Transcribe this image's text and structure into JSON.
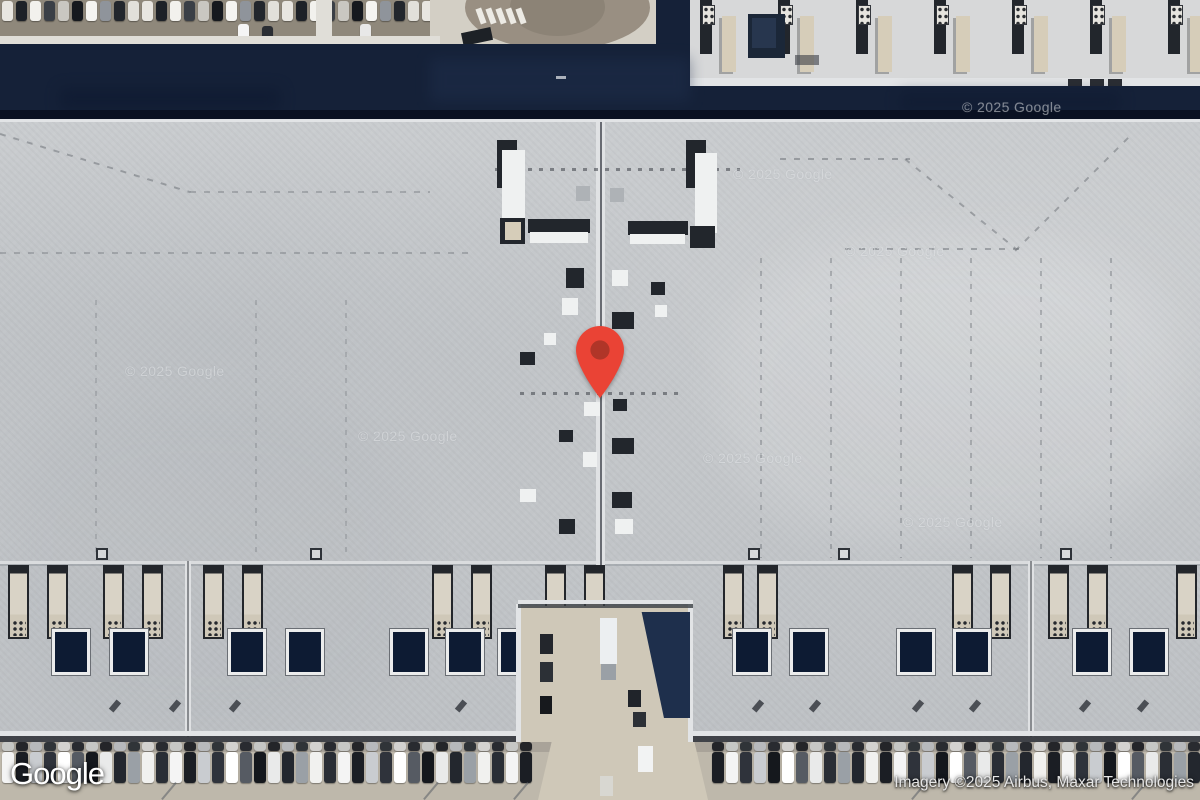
{
  "overlay": {
    "logo_text": "Google",
    "attribution": "Imagery ©2025 Airbus, Maxar Technologies"
  },
  "map": {
    "watermark_text": "© 2025 Google",
    "watermarks": [
      {
        "x": 125,
        "y": 363
      },
      {
        "x": 358,
        "y": 428
      },
      {
        "x": 703,
        "y": 450
      },
      {
        "x": 903,
        "y": 514
      },
      {
        "x": 733,
        "y": 166
      },
      {
        "x": 845,
        "y": 243
      },
      {
        "x": 962,
        "y": 99
      }
    ],
    "pin": {
      "x": 600,
      "y": 398,
      "body": "#EA4335",
      "dot": "#B03528"
    },
    "colors": {
      "dirt": "#8f887b",
      "pave": "#d3cfc5",
      "walk": "#e0ded8",
      "bldg": "#d7d8d9",
      "edge": "#e2e4e6",
      "navy": "#152138",
      "navyDark": "#0a1122",
      "navyLight": "#20304e",
      "roof": "#c6c9cc",
      "dark": "#22262c",
      "white": "#eff1f1",
      "beige": "#d6cdb9",
      "tan": "#cfc8b8",
      "lot": "#beb8ab",
      "lotDark": "#a9a399"
    },
    "features": [
      {
        "x": 0,
        "y": 0,
        "w": 440,
        "h": 50,
        "f": "$dirt"
      },
      {
        "x0": 2,
        "y": 1,
        "w": 11,
        "h": 20,
        "gap": 3,
        "count": 31,
        "cls": "car",
        "colors": [
          "#e8e6e1",
          "#1d2127",
          "#f2f1ed",
          "#3a3f46",
          "#c9c7c1",
          "#16191e",
          "#f5f4f0",
          "#8f949b",
          "#22262c",
          "#e2e0da"
        ]
      },
      {
        "x": 238,
        "y": 24,
        "w": 11,
        "h": 16,
        "f": "#f5f5f5",
        "cls": "car"
      },
      {
        "x": 262,
        "y": 26,
        "w": 11,
        "h": 14,
        "f": "#2a2d33",
        "cls": "car"
      },
      {
        "x": 360,
        "y": 24,
        "w": 11,
        "h": 15,
        "f": "#e8e8e8",
        "cls": "car"
      },
      {
        "x": 316,
        "y": 0,
        "w": 16,
        "h": 44,
        "f": "$walk"
      },
      {
        "x": 430,
        "y": 0,
        "w": 240,
        "h": 48,
        "f": "$pave"
      },
      {
        "x": 465,
        "y": -35,
        "w": 185,
        "h": 85,
        "f": "#998f82",
        "cls": "ell"
      },
      {
        "x": 510,
        "y": -22,
        "w": 95,
        "h": 58,
        "f": "#8a8174",
        "cls": "ell",
        "op": 0.85
      },
      {
        "xs": [
          478,
          488,
          498,
          508,
          518
        ],
        "y": 8,
        "w": 6,
        "h": 16,
        "f": "#eceae4",
        "rot": -20
      },
      {
        "x": 462,
        "y": 30,
        "w": 30,
        "h": 13,
        "f": "#1d2126",
        "rot": -12
      },
      {
        "x": 688,
        "y": 0,
        "w": 512,
        "h": 84,
        "f": "$bldg"
      },
      {
        "x0": 700,
        "y": 0,
        "w": 40,
        "h": 76,
        "gap": 38,
        "count": 7,
        "cls": "mod"
      },
      {
        "x0": 702,
        "y": 5,
        "w": 13,
        "h": 20,
        "gap": 65,
        "count": 7,
        "cls": "grid"
      },
      {
        "x": 748,
        "y": 14,
        "w": 37,
        "h": 44,
        "f": "#1b2738"
      },
      {
        "x": 752,
        "y": 18,
        "w": 24,
        "h": 30,
        "f": "#27364e"
      },
      {
        "x": 795,
        "y": 55,
        "w": 24,
        "h": 10,
        "f": "#3a3e44",
        "op": 0.6
      },
      {
        "x": 688,
        "y": 78,
        "w": 512,
        "h": 10,
        "f": "$edge"
      },
      {
        "xs": [
          1068,
          1090,
          1108
        ],
        "y": 79,
        "w": 14,
        "h": 8,
        "f": "#2a2d33"
      },
      {
        "x": 0,
        "y": 36,
        "w": 440,
        "h": 10,
        "f": "$walk"
      },
      {
        "x": 0,
        "y": 44,
        "w": 658,
        "h": 76,
        "f": "$navy"
      },
      {
        "x": 656,
        "y": 0,
        "w": 34,
        "h": 120,
        "f": "$navy"
      },
      {
        "x": 688,
        "y": 86,
        "w": 512,
        "h": 34,
        "f": "$navy"
      },
      {
        "x": 430,
        "y": 58,
        "w": 260,
        "h": 44,
        "f": "$navyLight",
        "op": 0.45,
        "cls": "blur"
      },
      {
        "x": 60,
        "y": 88,
        "w": 220,
        "h": 22,
        "f": "#0e1930",
        "op": 0.6,
        "cls": "blur"
      },
      {
        "x": 900,
        "y": 92,
        "w": 220,
        "h": 20,
        "f": "#0e1930",
        "op": 0.5,
        "cls": "blur"
      },
      {
        "x": 556,
        "y": 76,
        "w": 10,
        "h": 3,
        "f": "#cfd4da",
        "op": 0.8
      },
      {
        "x": 0,
        "y": 110,
        "w": 1200,
        "h": 10,
        "f": "$navyDark"
      },
      {
        "x": 0,
        "y": 119,
        "w": 1200,
        "h": 4,
        "f": "$edge"
      },
      {
        "x": 0,
        "y": 122,
        "w": 1200,
        "h": 620,
        "f": "$roof"
      },
      {
        "x": 0,
        "y": 122,
        "w": 1200,
        "h": 620,
        "cls": "wash1"
      },
      {
        "x": 0,
        "y": 400,
        "w": 420,
        "h": 330,
        "f": "#a9aeb4",
        "op": 0.16,
        "cls": "blur2"
      },
      {
        "x": 720,
        "y": 240,
        "w": 460,
        "h": 300,
        "f": "#ffffff",
        "op": 0.12,
        "cls": "blur2"
      },
      {
        "x": 0,
        "y": 122,
        "w": 1200,
        "h": 620,
        "cls": "grain"
      },
      {
        "x": 0,
        "y": 561,
        "w": 1200,
        "h": 3,
        "f": "#dadcde"
      },
      {
        "x": 0,
        "y": 564,
        "w": 1200,
        "h": 2,
        "f": "#90959b",
        "op": 0.5
      },
      {
        "x": 596,
        "y": 122,
        "w": 9,
        "h": 492,
        "f": "#e0e2e4"
      },
      {
        "x": 600,
        "y": 122,
        "w": 2,
        "h": 492,
        "f": "#4a4e55",
        "op": 0.8
      },
      {
        "x": 185,
        "y": 561,
        "w": 6,
        "h": 176,
        "f": "#dfe1e3"
      },
      {
        "x": 187,
        "y": 561,
        "w": 2,
        "h": 176,
        "f": "#5a5e64",
        "op": 0.65
      },
      {
        "x": 1028,
        "y": 561,
        "w": 6,
        "h": 176,
        "f": "#dfe1e3"
      },
      {
        "x": 1030,
        "y": 561,
        "w": 2,
        "h": 176,
        "f": "#5a5e64",
        "op": 0.65
      },
      {
        "xs": [
          760,
          830,
          900,
          970,
          1040,
          1110
        ],
        "y": 258,
        "w": 2,
        "h": 300,
        "cls": "dashv"
      },
      {
        "xs": [
          95,
          255,
          345
        ],
        "y": 300,
        "w": 2,
        "h": 258,
        "cls": "dashv",
        "op": 0.22
      },
      {
        "x": 0,
        "y": 252,
        "w": 470,
        "h": 2,
        "cls": "dashh",
        "op": 0.3
      },
      {
        "x": 780,
        "y": 158,
        "w": 130,
        "h": 2,
        "cls": "dashh"
      },
      {
        "x": 845,
        "y": 248,
        "w": 175,
        "h": 2,
        "cls": "dashh"
      },
      {
        "x": 905,
        "y": 158,
        "w": 142,
        "h": 2,
        "cls": "dashh",
        "rot": 39
      },
      {
        "x": 1015,
        "y": 250,
        "w": 162,
        "h": 2,
        "cls": "dashh",
        "rot": -45
      },
      {
        "x": 0,
        "y": 133,
        "w": 199,
        "h": 2,
        "cls": "dashh",
        "rot": 17
      },
      {
        "x": 190,
        "y": 191,
        "w": 240,
        "h": 2,
        "cls": "dashh",
        "op": 0.3
      },
      {
        "x": 495,
        "y": 168,
        "w": 245,
        "h": 3,
        "cls": "dots"
      },
      {
        "x": 520,
        "y": 392,
        "w": 160,
        "h": 3,
        "cls": "dots"
      },
      {
        "x": 497,
        "y": 140,
        "w": 20,
        "h": 48,
        "f": "$dark"
      },
      {
        "x": 502,
        "y": 150,
        "w": 23,
        "h": 72,
        "f": "$white"
      },
      {
        "x": 500,
        "y": 218,
        "w": 25,
        "h": 26,
        "f": "$dark"
      },
      {
        "x": 505,
        "y": 222,
        "w": 16,
        "h": 18,
        "f": "$beige"
      },
      {
        "x": 528,
        "y": 219,
        "w": 62,
        "h": 14,
        "f": "$dark"
      },
      {
        "x": 530,
        "y": 232,
        "w": 58,
        "h": 11,
        "f": "$white"
      },
      {
        "x": 576,
        "y": 186,
        "w": 14,
        "h": 15,
        "f": "#aeb2b6"
      },
      {
        "x": 686,
        "y": 140,
        "w": 20,
        "h": 48,
        "f": "$dark"
      },
      {
        "x": 695,
        "y": 153,
        "w": 22,
        "h": 80,
        "f": "$white"
      },
      {
        "x": 690,
        "y": 226,
        "w": 25,
        "h": 22,
        "f": "$dark"
      },
      {
        "x": 628,
        "y": 221,
        "w": 60,
        "h": 14,
        "f": "$dark"
      },
      {
        "x": 630,
        "y": 234,
        "w": 55,
        "h": 10,
        "f": "$white"
      },
      {
        "x": 610,
        "y": 188,
        "w": 14,
        "h": 14,
        "f": "#aeb2b6"
      },
      {
        "x": 566,
        "y": 268,
        "w": 18,
        "h": 20,
        "f": "$dark"
      },
      {
        "x": 612,
        "y": 270,
        "w": 16,
        "h": 16,
        "f": "$white"
      },
      {
        "x": 562,
        "y": 298,
        "w": 16,
        "h": 17,
        "f": "$white"
      },
      {
        "x": 612,
        "y": 312,
        "w": 22,
        "h": 17,
        "f": "$dark"
      },
      {
        "x": 651,
        "y": 282,
        "w": 14,
        "h": 13,
        "f": "$dark"
      },
      {
        "x": 655,
        "y": 305,
        "w": 12,
        "h": 12,
        "f": "$white"
      },
      {
        "x": 520,
        "y": 352,
        "w": 15,
        "h": 13,
        "f": "$dark"
      },
      {
        "x": 544,
        "y": 333,
        "w": 12,
        "h": 12,
        "f": "$white"
      },
      {
        "x": 584,
        "y": 402,
        "w": 16,
        "h": 14,
        "f": "$white"
      },
      {
        "x": 613,
        "y": 399,
        "w": 14,
        "h": 12,
        "f": "$dark"
      },
      {
        "x": 559,
        "y": 430,
        "w": 14,
        "h": 12,
        "f": "$dark"
      },
      {
        "x": 612,
        "y": 438,
        "w": 22,
        "h": 16,
        "f": "$dark"
      },
      {
        "x": 583,
        "y": 452,
        "w": 14,
        "h": 15,
        "f": "$white"
      },
      {
        "x": 520,
        "y": 489,
        "w": 16,
        "h": 13,
        "f": "$white"
      },
      {
        "x": 612,
        "y": 492,
        "w": 20,
        "h": 16,
        "f": "$dark"
      },
      {
        "x": 559,
        "y": 519,
        "w": 16,
        "h": 15,
        "f": "$dark"
      },
      {
        "x": 615,
        "y": 519,
        "w": 18,
        "h": 15,
        "f": "$white"
      },
      {
        "xs": [
          96,
          310,
          748,
          838,
          1060
        ],
        "y": 548,
        "w": 12,
        "h": 12,
        "cls": "hatch"
      },
      {
        "xs": [
          8,
          47,
          103,
          142,
          203,
          242,
          432,
          471,
          545,
          584,
          723,
          757,
          952,
          990,
          1048,
          1087,
          1176
        ],
        "y": 565,
        "w": 21,
        "h": 74,
        "cls": "vent"
      },
      {
        "xs": [
          52,
          110,
          228,
          286,
          390,
          446,
          498,
          733,
          790,
          897,
          953,
          1073,
          1130
        ],
        "y": 629,
        "w": 38,
        "h": 46,
        "cls": "sky"
      },
      {
        "xs": [
          112,
          172,
          232,
          458,
          755,
          812,
          915,
          972,
          1082,
          1140
        ],
        "y": 700,
        "w": 6,
        "h": 12,
        "f": "#2e3238",
        "rot": 40,
        "op": 0.8
      },
      {
        "x": 0,
        "y": 731,
        "w": 1200,
        "h": 5,
        "f": "$edge"
      },
      {
        "x": 0,
        "y": 736,
        "w": 1200,
        "h": 8,
        "f": "#2a2d33",
        "op": 0.85
      },
      {
        "x": 518,
        "y": 606,
        "w": 174,
        "h": 140,
        "f": "$tan"
      },
      {
        "x": 516,
        "y": 604,
        "w": 5,
        "h": 142,
        "f": "$edge"
      },
      {
        "x": 688,
        "y": 604,
        "w": 5,
        "h": 142,
        "f": "$edge"
      },
      {
        "x": 518,
        "y": 600,
        "w": 175,
        "h": 4,
        "f": "$edge"
      },
      {
        "x": 518,
        "y": 604,
        "w": 175,
        "h": 4,
        "f": "#3a3e44",
        "op": 0.8
      },
      {
        "x": 628,
        "y": 612,
        "w": 62,
        "h": 106,
        "f": "#1e2f4c",
        "clip": "polygon(22% 0,100% 0,100% 100%,58% 100%)"
      },
      {
        "x": 600,
        "y": 618,
        "w": 17,
        "h": 46,
        "f": "#eceff1"
      },
      {
        "x": 601,
        "y": 664,
        "w": 15,
        "h": 16,
        "f": "#9aa0a6"
      },
      {
        "x": 540,
        "y": 634,
        "w": 13,
        "h": 20,
        "f": "#23262c"
      },
      {
        "x": 540,
        "y": 662,
        "w": 13,
        "h": 20,
        "f": "#2c3036"
      },
      {
        "x": 540,
        "y": 696,
        "w": 12,
        "h": 18,
        "f": "#17191d"
      },
      {
        "x": 628,
        "y": 690,
        "w": 13,
        "h": 17,
        "f": "#20242a"
      },
      {
        "x": 633,
        "y": 712,
        "w": 13,
        "h": 15,
        "f": "#2c3036"
      },
      {
        "x": 0,
        "y": 742,
        "w": 1200,
        "h": 58,
        "f": "$lot"
      },
      {
        "x": 0,
        "y": 742,
        "w": 1200,
        "h": 10,
        "f": "$lotDark"
      },
      {
        "x0": 2,
        "y": 742,
        "w": 12,
        "h": 9,
        "gap": 2,
        "count": 38,
        "cls": "car",
        "op": 0.9,
        "colors": [
          "#caccca",
          "#16181d",
          "#b9bcc0",
          "#24282e",
          "#d8d8d6",
          "#1c1f25"
        ]
      },
      {
        "x0": 712,
        "y": 742,
        "w": 12,
        "h": 9,
        "gap": 2,
        "count": 35,
        "cls": "car",
        "op": 0.9,
        "colors": [
          "#16181d",
          "#caccca",
          "#24282e",
          "#b9bcc0",
          "#1c1f25",
          "#d8d8d6"
        ]
      },
      {
        "x0": 2,
        "y": 752,
        "w": 12,
        "h": 31,
        "gap": 2,
        "count": 38,
        "cls": "car",
        "colors": [
          "#f4f4f4",
          "#1b1e24",
          "#c9ccd0",
          "#2f333b",
          "#ffffff",
          "#565b63",
          "#15181d",
          "#e9eaea",
          "#23272e",
          "#9aa0a6",
          "#f1f1ef",
          "#2a2e35"
        ]
      },
      {
        "x0": 712,
        "y": 752,
        "w": 12,
        "h": 31,
        "gap": 2,
        "count": 35,
        "cls": "car",
        "colors": [
          "#1b1e24",
          "#f4f4f4",
          "#2f333b",
          "#c9ccd0",
          "#15181d",
          "#ffffff",
          "#565b63",
          "#e9eaea",
          "#2a2e35",
          "#9aa0a6",
          "#23272e",
          "#f1f1ef"
        ]
      },
      {
        "x": 538,
        "y": 742,
        "w": 170,
        "h": 58,
        "f": "$tan",
        "clip": "polygon(8% 0,92% 0,100% 100%,0 100%)"
      },
      {
        "x": 638,
        "y": 746,
        "w": 15,
        "h": 26,
        "f": "#f2f3f3"
      },
      {
        "x": 600,
        "y": 776,
        "w": 13,
        "h": 20,
        "f": "#d8d8d4",
        "op": 0.9
      },
      {
        "xs": [
          168,
          430,
          520,
          918,
          1138
        ],
        "y": 780,
        "w": 2,
        "h": 22,
        "f": "#5a5f66",
        "rot": 40,
        "op": 0.55
      }
    ]
  }
}
